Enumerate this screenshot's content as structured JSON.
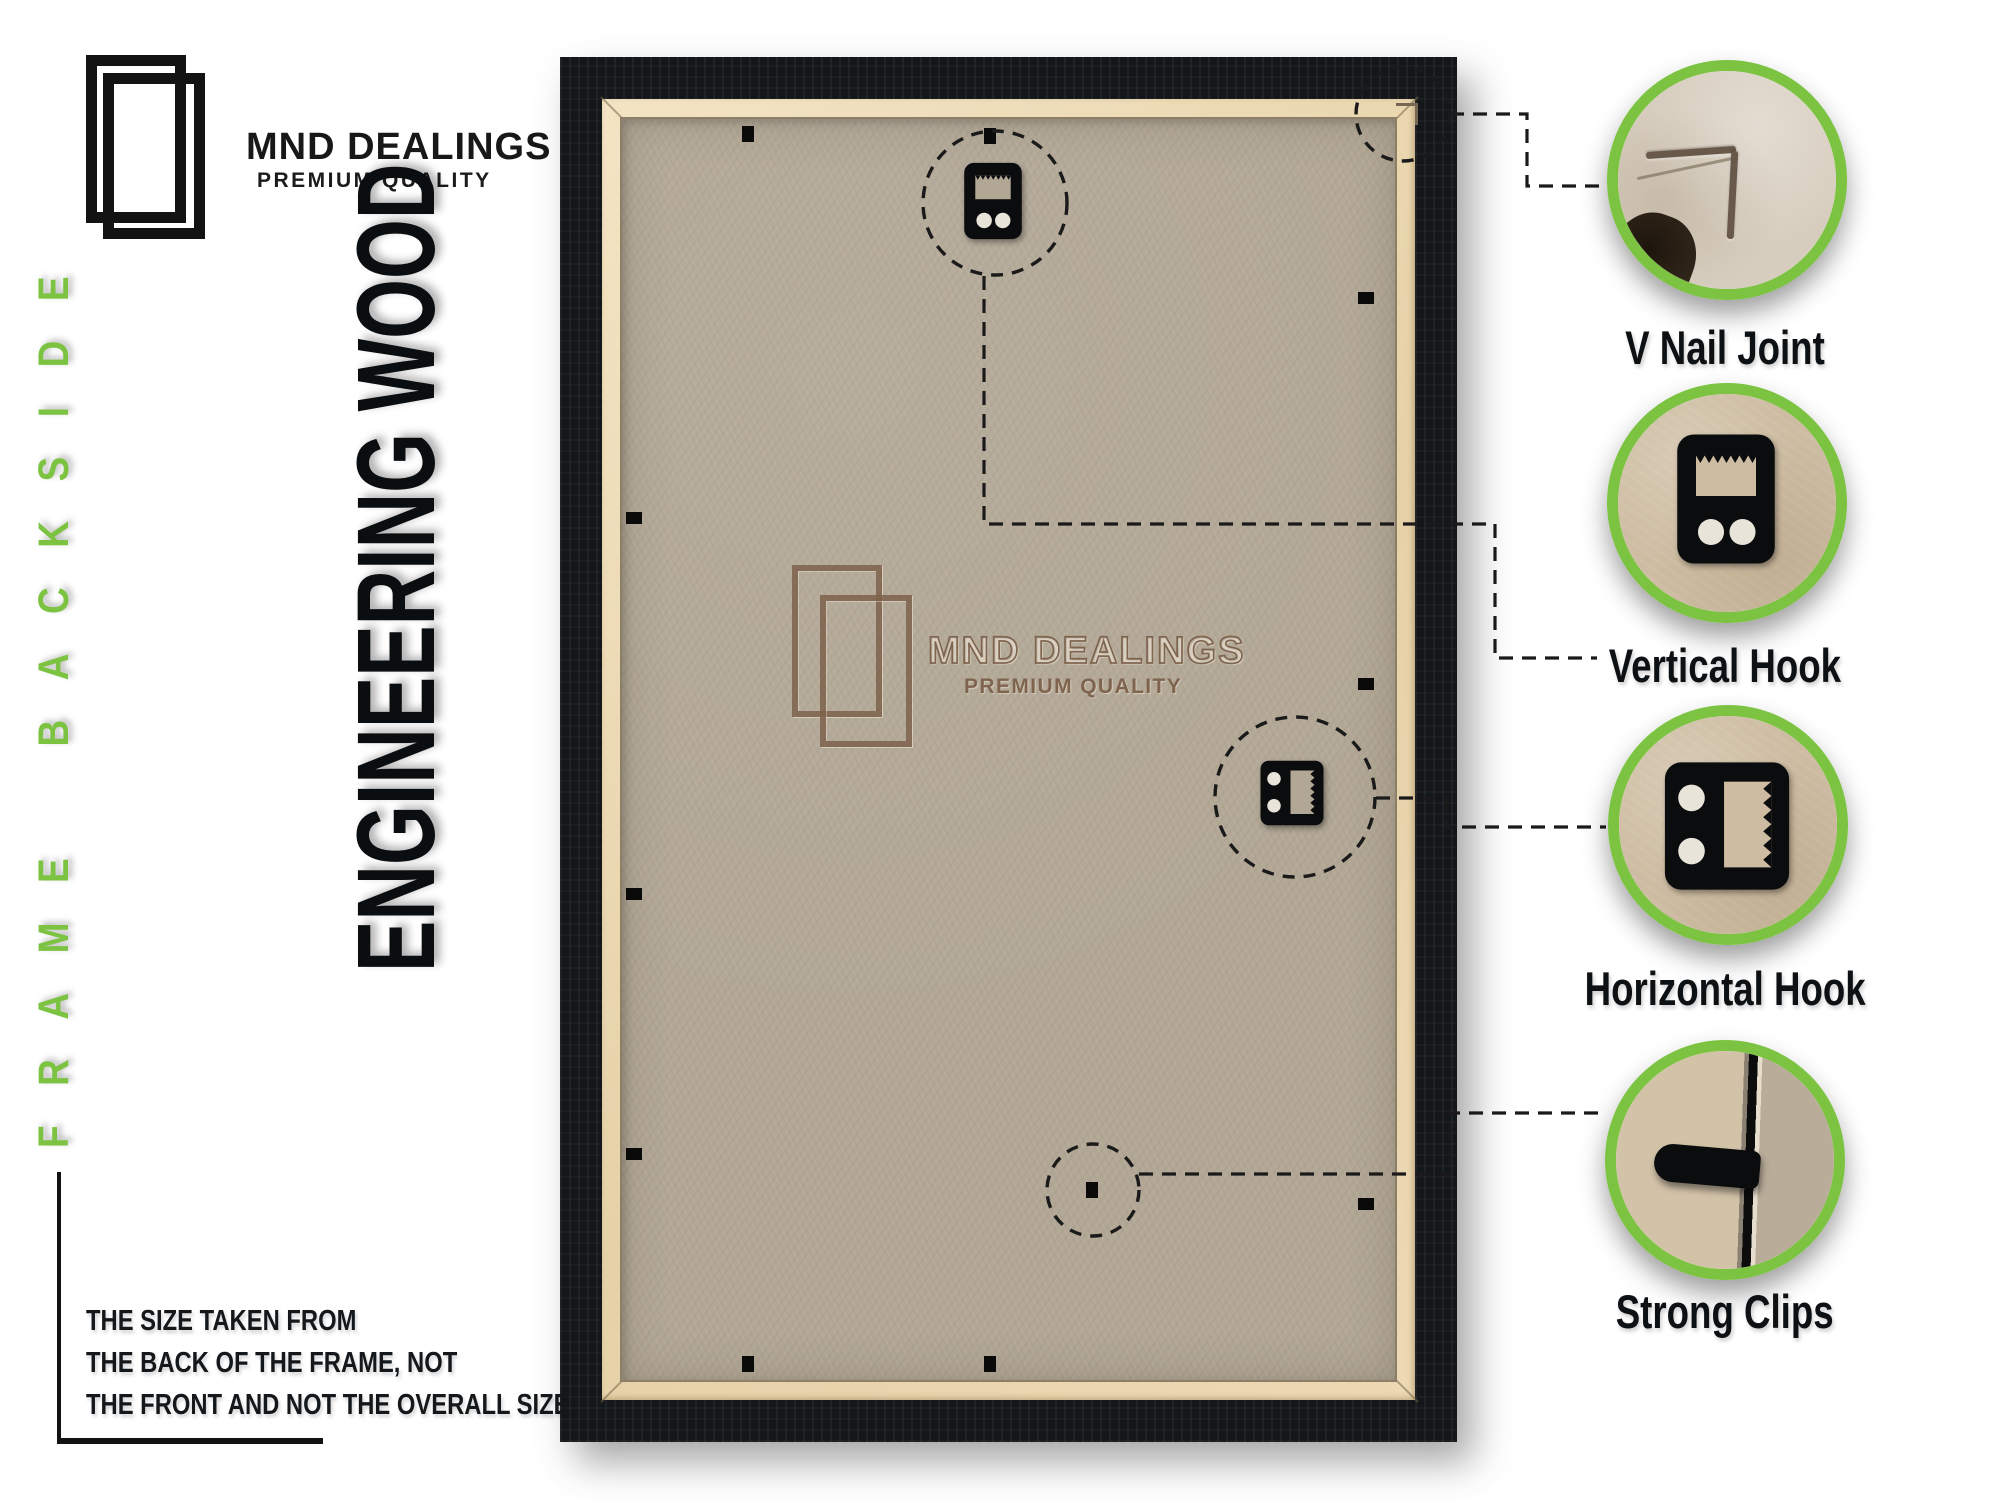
{
  "brand": {
    "name": "MND DEALINGS",
    "tagline": "PREMIUM QUALITY"
  },
  "side_label": "FRAME BACKSIDE",
  "material_label": "ENGINEERING WOOD",
  "watermark": {
    "name": "MND DEALINGS",
    "tagline": "PREMIUM QUALITY"
  },
  "callouts": [
    {
      "label": "V Nail Joint"
    },
    {
      "label": "Vertical Hook"
    },
    {
      "label": "Horizontal Hook"
    },
    {
      "label": "Strong Clips"
    }
  ],
  "disclaimer": {
    "line1": "THE SIZE TAKEN FROM",
    "line2": "THE BACK OF THE FRAME, NOT",
    "line3": "THE FRONT AND NOT THE OVERALL SIZE."
  },
  "icons": {
    "brand_logo": "double-frame-icon",
    "watermark_logo": "double-frame-icon",
    "vertical_hook": "vertical-hook-icon",
    "horizontal_hook": "horizontal-hook-icon",
    "v_nail": "v-nail-corner-icon",
    "strong_clip": "strong-clip-icon",
    "staple": "staple-mark-icon"
  },
  "colors": {
    "accent_green": "#7cc342",
    "frame_black": "#14171a",
    "board_tan": "#b2a795",
    "liner_cream": "#ead9b5",
    "watermark_brown": "#8d7460",
    "text_black": "#14181b"
  }
}
